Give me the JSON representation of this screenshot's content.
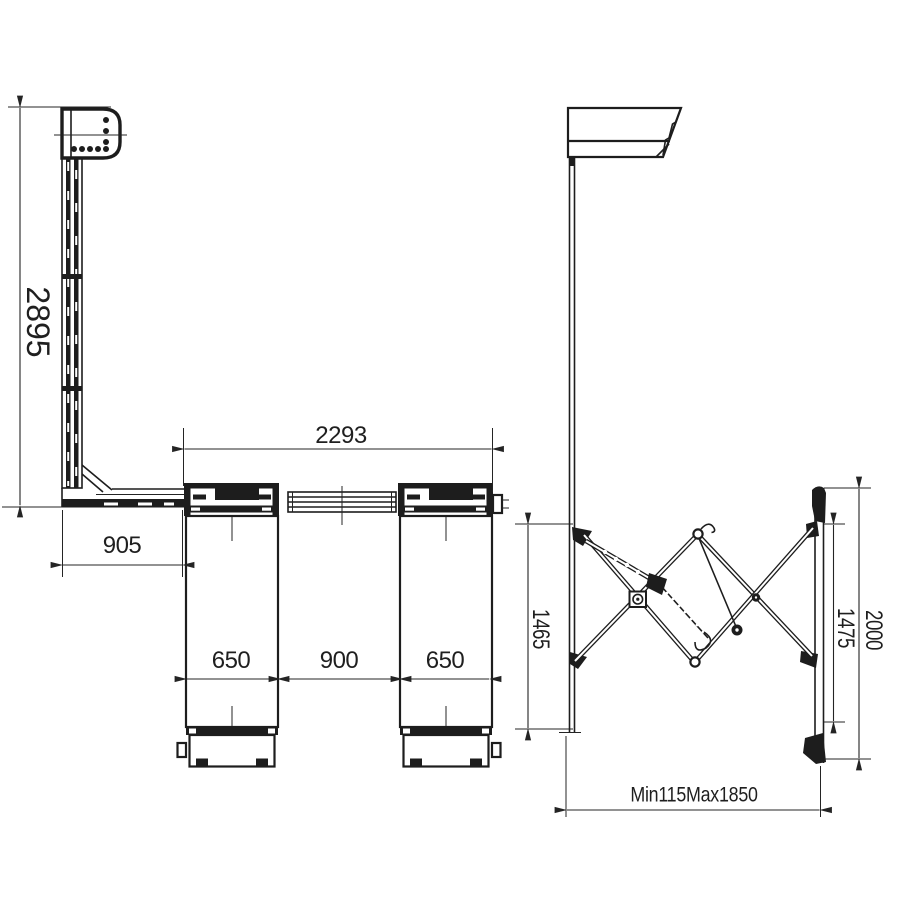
{
  "drawing": {
    "title": "wall-mount lift technical dimension drawing",
    "background": "#ffffff",
    "line_color": "#1d1d1d",
    "views": {
      "front": {
        "name": "front elevation",
        "dimensions": {
          "column_height": "2895",
          "base_arm_length": "905",
          "overall_span": "2293",
          "left_leg_width": "650",
          "center_gap": "900",
          "right_leg_width": "650"
        }
      },
      "side": {
        "name": "side elevation",
        "dimensions": {
          "pole_extension": "1465",
          "bracket_inner_height": "1475",
          "bracket_overall_height": "2000",
          "horizontal_reach": "Min115Max1850"
        }
      }
    }
  }
}
